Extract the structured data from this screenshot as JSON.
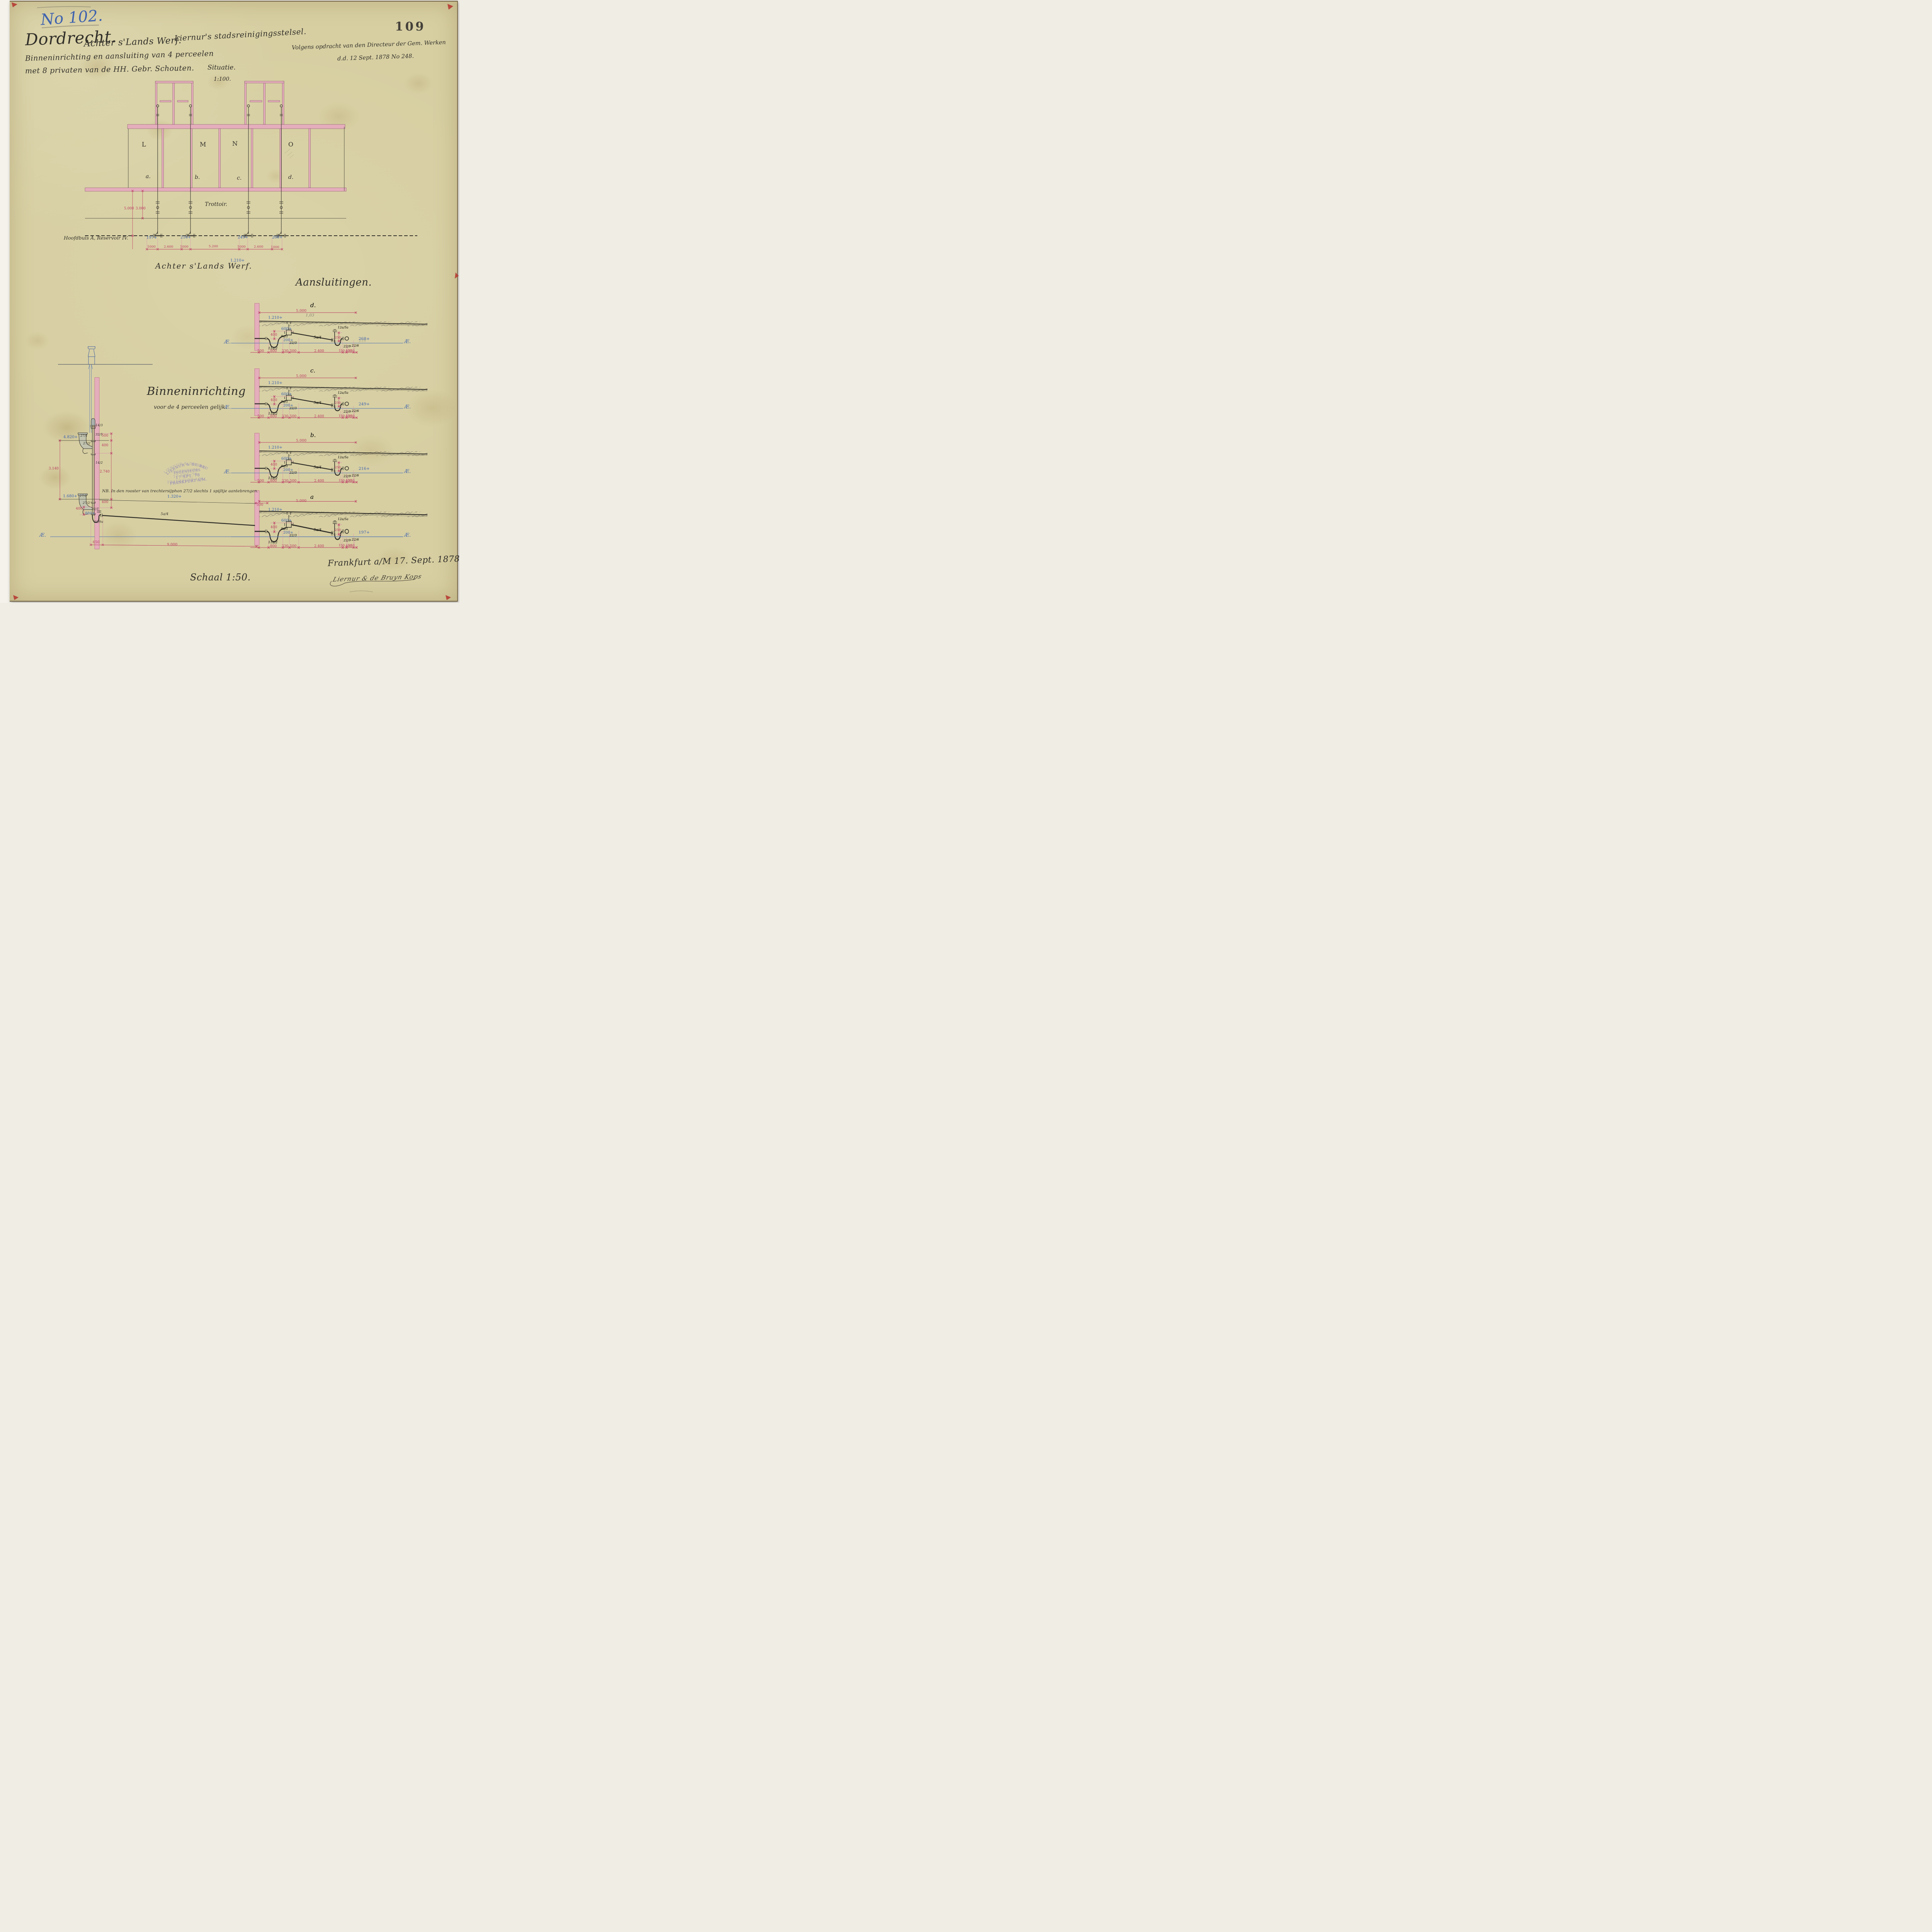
{
  "page": {
    "archive_number": "109",
    "colors": {
      "paper": "#d7cfa2",
      "ink": "#32302a",
      "blue": "#3f63ae",
      "red": "#bb3a60",
      "pink_wall": "#e5aebc",
      "pencil": "#85806f",
      "stamp": "#7d74bd"
    }
  },
  "header": {
    "drawing_no": "No 102.",
    "city": "Dordrecht.",
    "location": "Achter s'Lands Werf.",
    "system": "Liernur's stadsreinigingsstelsel.",
    "subtitle1": "Binneninrichting en aansluiting van 4 perceelen",
    "subtitle2": "met 8 privaten van de HH. Gebr. Schouten.",
    "commission1": "Volgens opdracht van den Directeur der Gem. Werken",
    "commission2": "d.d. 12 Sept. 1878 No 248.",
    "situatie_label": "Situatie.",
    "situatie_scale": "1:100."
  },
  "situatie": {
    "rooms": [
      "L",
      "M",
      "N",
      "O"
    ],
    "parcels": [
      "a.",
      "b.",
      "c.",
      "d."
    ],
    "trottoir": "Trottoir.",
    "dim_v1": "5.000",
    "dim_v2": "3.000",
    "hoofdbuis": "Hoofdbuis A, Reservoir IV.",
    "levels": [
      "197+",
      "216+",
      "249+",
      "268+"
    ],
    "dims_bottom": [
      "1000",
      "2.600",
      "1000",
      "5.200",
      "1000",
      "2.600",
      "1000"
    ],
    "level_center": "1.210+",
    "street_name": "Achter  s'Lands  Werf."
  },
  "aansluitingen": {
    "title": "Aansluitingen.",
    "pencil_note_d": "1,03",
    "pencil_ghost_d": "216",
    "sections": [
      {
        "label": "d.",
        "dim_top": "5.000",
        "level_ground": "1.210+",
        "level_gully": "600+",
        "dim_400": "400",
        "part_9a1": "9a/1",
        "level_200": "200+",
        "part_223": "22/3",
        "part_5a4": "5a/4",
        "part_11a2": "11a/2",
        "part_12a5a": "12a/5a",
        "dim_250": "250",
        "part_229": "22/9",
        "part_226": "22/6",
        "dim_150a": "150",
        "dim_150b": "150",
        "b1": "500",
        "b2": "800",
        "b3": "330",
        "b4": "500",
        "b5": "2.400",
        "b6": "400",
        "level_end": "268+",
        "ap_left": "Æ.",
        "ap_right": "Æ."
      },
      {
        "label": "c.",
        "dim_top": "5.000",
        "level_ground": "1.210+",
        "level_gully": "600+",
        "dim_400": "400",
        "part_9a1": "9a/1",
        "level_200": "200+",
        "part_223": "22/3",
        "part_5a4": "5a/4",
        "part_11a2": "11a/2",
        "part_12a5a": "12a/5a",
        "dim_250": "250",
        "part_229": "22/9",
        "part_226": "22/6",
        "dim_150a": "150",
        "dim_150b": "150",
        "b1": "500",
        "b2": "800",
        "b3": "330",
        "b4": "500",
        "b5": "2.400",
        "b6": "400",
        "level_end": "249+",
        "ap_left": "Æ.",
        "ap_right": "Æ."
      },
      {
        "label": "b.",
        "dim_top": "5.000",
        "level_ground": "1.210+",
        "level_gully": "600+",
        "dim_400": "400",
        "part_9a1": "9a/1",
        "level_200": "200+",
        "part_223": "22/3",
        "part_5a4": "5a/4",
        "part_11a2": "11a/2",
        "part_12a5a": "12a/5a",
        "dim_250": "250",
        "part_229": "22/9",
        "part_226": "22/6",
        "dim_150a": "150",
        "dim_150b": "150",
        "b1": "500",
        "b2": "800",
        "b3": "330",
        "b4": "500",
        "b5": "2.400",
        "b6": "400",
        "level_end": "216+",
        "ap_left": "Æ.",
        "ap_right": "Æ."
      },
      {
        "label": "a",
        "dim_top": "5.000",
        "dim_left_500": "500",
        "dim_long": "9.000",
        "level_ground": "1.210+",
        "level_gully": "600+",
        "dim_400": "400",
        "part_9a1": "9a/1",
        "level_200": "200+",
        "part_223": "22/3",
        "part_5a4": "5a/4",
        "part_11a2": "11a/2",
        "part_12a5a": "12a/5a",
        "dim_250": "250",
        "part_229": "22/9",
        "part_226": "22/6",
        "dim_150a": "150",
        "dim_150b": "150",
        "b1": "",
        "b2": "800",
        "b3": "330",
        "b4": "500",
        "b5": "2.400",
        "b6": "400",
        "level_end": "197+",
        "ap_left": "Æ.",
        "ap_right": "Æ."
      }
    ]
  },
  "binneninrichting": {
    "title": "Binneninrichting",
    "subtitle": "voor de 4 perceelen gelijk.",
    "nb_note": "NB. In den rooster van trechtersijphon 27/2 slechts 1 spijltje aantebrengen.",
    "level_4820": "4.820+",
    "level_1680": "1.680+",
    "level_880": "880+",
    "level_1320": "1.320+",
    "dim_500": "500",
    "dim_400a": "400",
    "dim_2740": "2.740",
    "dim_400b": "400",
    "dim_3140": "3.140",
    "dim_400c": "400",
    "dim_650": "650",
    "part_14_3": "14/3",
    "part_32_1": "32/1",
    "part_14_2": "14/2",
    "part_27_1a": "27/1",
    "part_27_2a": "27/2",
    "part_27_1b": "27/1",
    "part_27_2b": "27/2",
    "part_32_1b": "32/1",
    "part_20_9a": "20/9a",
    "part_5a4": "5a/4",
    "ap": "Æ."
  },
  "stamp": {
    "line1": "LIERNUR & DE BRUYN-KOPS",
    "line2": "INGENIEURS",
    "line3": "17 SPT. 78",
    "line4": "FRANKFURT A/M."
  },
  "footer": {
    "place_date": "Frankfurt a/M 17. Sept. 1878.",
    "signature": "Liernur & de Bruyn Kops",
    "scale": "Schaal 1:50."
  }
}
